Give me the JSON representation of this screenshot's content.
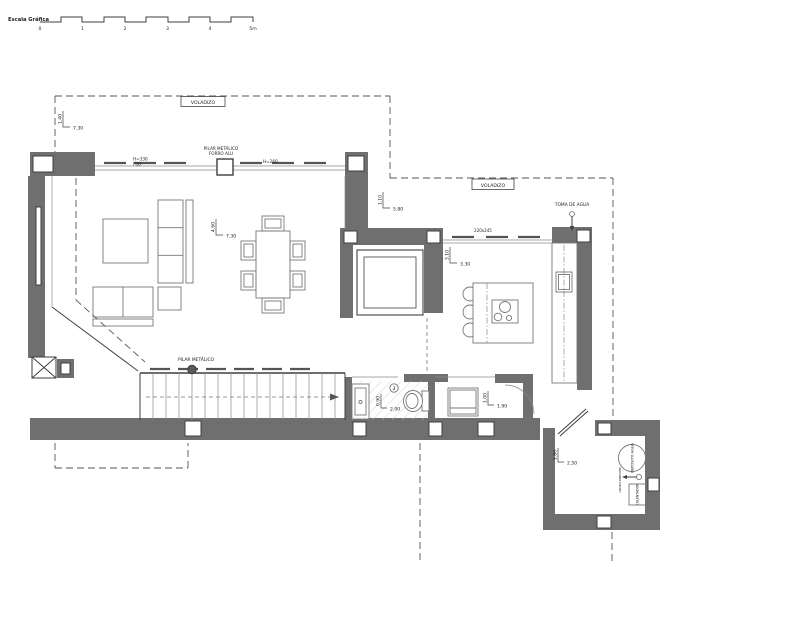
{
  "scale_bar": {
    "title": "Escala Gráfica",
    "ticks": [
      "0",
      "1",
      "2",
      "3",
      "4",
      "5m"
    ]
  },
  "overhang": {
    "left_label": "VOLADIZO",
    "right_label": "VOLADIZO"
  },
  "annotations": {
    "glazing_height_line1": "H=330",
    "glazing_height_line2": "FIJO",
    "north_pillar_line1": "PILAR METÁLICO",
    "north_pillar_line2": "FORRO ALU",
    "glazing_height_right": "H=260",
    "kitchen_window_size": "220x245",
    "water_intake": "TOMA DE AGUA",
    "stairs_pillar": "PILAR METÁLICO",
    "bath_room_number": "3",
    "utility_tank": "DEPÓSITO AGUA",
    "utility_pump": "GRUPO PRESIÓN",
    "utility_boiler": "CALENTADOR"
  },
  "dimensions": {
    "overhang_left": {
      "v": "1.40",
      "h": "7.30"
    },
    "living": {
      "v": "4.60",
      "h": "7.30"
    },
    "overhang_right": {
      "v": "1.10",
      "h": "5.80"
    },
    "kitchen": {
      "v": "3.10",
      "h": "3.30"
    },
    "bathroom": {
      "v": "0.90",
      "h": "2.00"
    },
    "laundry": {
      "v": "1.00",
      "h": "1.90"
    },
    "utility": {
      "v": "1.80",
      "h": "2.50"
    }
  },
  "colors": {
    "wall": "#6f6f6f",
    "line": "#3f3f3f",
    "dashed": "#555555",
    "hatch": "#c9c9c9"
  }
}
